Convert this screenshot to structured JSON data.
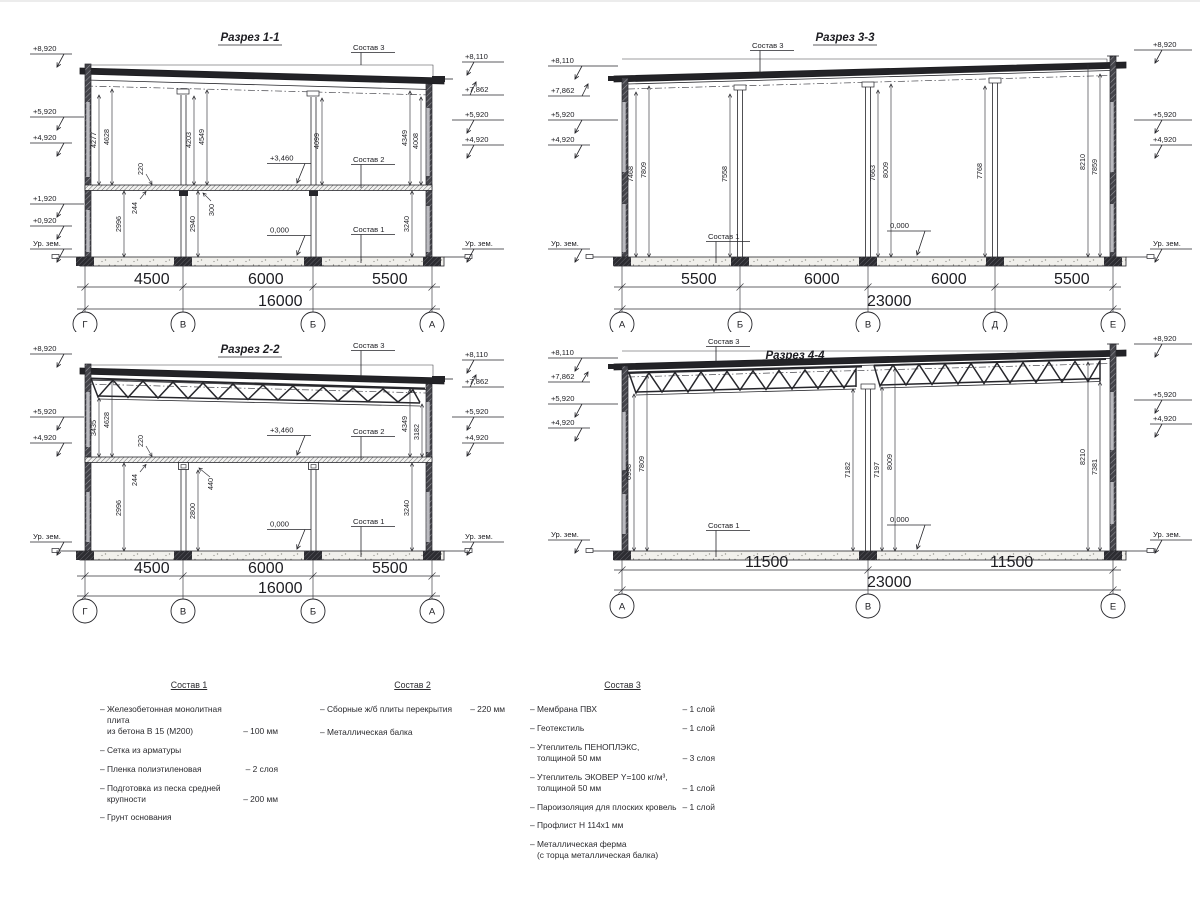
{
  "meta": {
    "ink": "#26262b",
    "bg": "#ffffff"
  },
  "s1": {
    "title": "Разрез 1-1",
    "ll": [
      "+8,920",
      "+5,920",
      "+4,920",
      "+1,920",
      "+0,920",
      "Ур. зем."
    ],
    "rl": [
      "+8,110",
      "+7,862",
      "+5,920",
      "+4,920",
      "Ур. зем."
    ],
    "vd": [
      "4277",
      "4628",
      "4203",
      "4549",
      "4099",
      "4349",
      "4008"
    ],
    "ld": [
      "2996",
      "2940",
      "3240"
    ],
    "sd": [
      "220",
      "244",
      "300"
    ],
    "mk": [
      "+3,460",
      "0,000"
    ],
    "co": [
      "Состав 3",
      "Состав 2",
      "Состав 1"
    ],
    "bd": [
      "4500",
      "6000",
      "5500"
    ],
    "tt": "16000",
    "gr": [
      "Г",
      "В",
      "Б",
      "А"
    ]
  },
  "s2": {
    "title": "Разрез 2-2",
    "ll": [
      "+8,920",
      "+5,920",
      "+4,920",
      "Ур. зем."
    ],
    "rl": [
      "+8,110",
      "+7,862",
      "+5,920",
      "+4,920",
      "Ур. зем."
    ],
    "vd": [
      "3435",
      "4628",
      "4349",
      "3182"
    ],
    "ld": [
      "2996",
      "2800",
      "3240"
    ],
    "sd": [
      "220",
      "244",
      "440"
    ],
    "mk": [
      "+3,460",
      "0,000"
    ],
    "co": [
      "Состав 3",
      "Состав 2",
      "Состав 1"
    ],
    "bd": [
      "4500",
      "6000",
      "5500"
    ],
    "tt": "16000",
    "gr": [
      "Г",
      "В",
      "Б",
      "А"
    ]
  },
  "s3": {
    "title": "Разрез 3-3",
    "ll": [
      "+8,110",
      "+7,862",
      "+5,920",
      "+4,920",
      "Ур. зем."
    ],
    "rl": [
      "+8,920",
      "+5,920",
      "+4,920",
      "Ур. зем."
    ],
    "vd": [
      "7468",
      "7809",
      "7558",
      "7663",
      "8009",
      "7768",
      "8210",
      "7859"
    ],
    "mk": [
      "0,000"
    ],
    "co": [
      "Состав 3",
      "Состав 1"
    ],
    "bd": [
      "5500",
      "6000",
      "6000",
      "5500"
    ],
    "tt": "23000",
    "gr": [
      "А",
      "Б",
      "В",
      "Д",
      "Е"
    ]
  },
  "s4": {
    "title": "Разрез 4-4",
    "ll": [
      "+8,110",
      "+7,862",
      "+5,920",
      "+4,920",
      "Ур. зем."
    ],
    "rl": [
      "+8,920",
      "+5,920",
      "+4,920",
      "Ур. зем."
    ],
    "vd": [
      "6998",
      "7809",
      "7182",
      "7197",
      "8009",
      "8210",
      "7381"
    ],
    "mk": [
      "0,000"
    ],
    "co": [
      "Состав 3",
      "Состав 1"
    ],
    "bd": [
      "11500",
      "11500"
    ],
    "tt": "23000",
    "gr": [
      "А",
      "В",
      "Е"
    ]
  },
  "legend": {
    "c1": {
      "title": "Состав 1",
      "items": [
        {
          "t": "– Железобетонная  монолитная плита\nиз бетона В 15 (М200)",
          "v": "– 100 мм"
        },
        {
          "t": "– Сетка из арматуры",
          "v": ""
        },
        {
          "t": "– Пленка полиэтиленовая",
          "v": "–  2 слоя"
        },
        {
          "t": "– Подготовка из песка средней\nкрупности",
          "v": "– 200 мм"
        },
        {
          "t": "– Грунт основания",
          "v": ""
        }
      ]
    },
    "c2": {
      "title": "Состав 2",
      "items": [
        {
          "t": "– Сборные ж/б плиты перекрытия",
          "v": "– 220 мм"
        },
        {
          "t": "– Металлическая балка",
          "v": ""
        }
      ]
    },
    "c3": {
      "title": "Состав 3",
      "items": [
        {
          "t": "– Мембрана ПВХ",
          "v": "– 1 слой"
        },
        {
          "t": "– Геотекстиль",
          "v": "– 1 слой"
        },
        {
          "t": "– Утеплитель ПЕНОПЛЭКС,\nтолщиной 50 мм",
          "v": "– 3 слоя"
        },
        {
          "t": "– Утеплитель ЭКОВЕР Y=100 кг/м³,\nтолщиной 50 мм",
          "v": "– 1 слой"
        },
        {
          "t": "– Пароизоляция для плоских кровель",
          "v": "– 1 слой"
        },
        {
          "t": "– Профлист Н 114х1 мм",
          "v": ""
        },
        {
          "t": "– Металлическая ферма\n(с торца металлическая балка)",
          "v": ""
        }
      ]
    }
  }
}
